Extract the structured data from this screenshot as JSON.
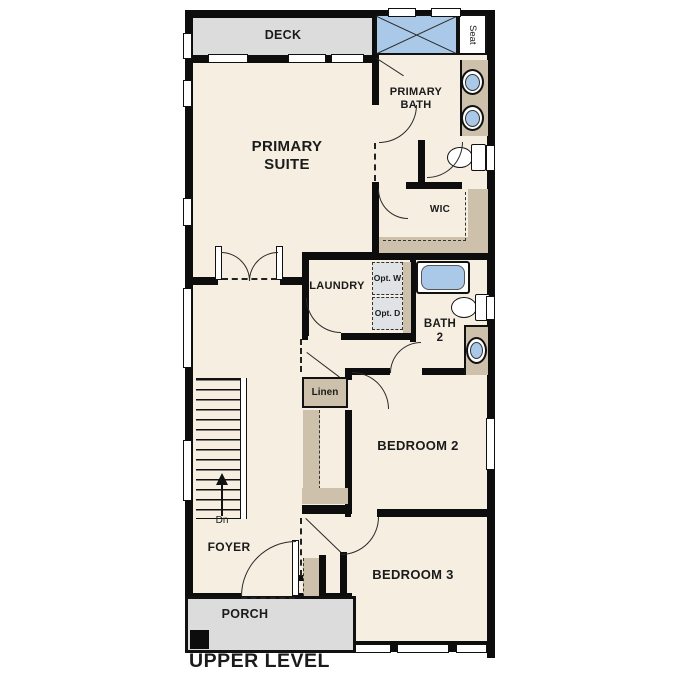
{
  "title": "UPPER LEVEL",
  "plan": {
    "rooms": {
      "deck": "DECK",
      "primary_suite": "PRIMARY SUITE",
      "primary_bath": "PRIMARY BATH",
      "wic": "WIC",
      "laundry": "LAUNDRY",
      "bath_2": "BATH 2",
      "bedroom_2": "BEDROOM 2",
      "bedroom_3": "BEDROOM 3",
      "foyer": "FOYER",
      "porch": "PORCH"
    },
    "features": {
      "seat": "Seat",
      "linen": "Linen",
      "opt_washer": "Opt. W",
      "opt_dryer": "Opt. D",
      "stairs_direction": "Dn"
    }
  },
  "colors": {
    "floor": "#f5eee1",
    "wall": "#0d0d0d",
    "deck_gray": "#dcdcdc",
    "cabinet": "#cdc1ab",
    "fixture_blue": "#aac9e9",
    "opt_gray": "#e0e3e6",
    "line": "#2a2a2a",
    "text": "#1b1b1b"
  }
}
